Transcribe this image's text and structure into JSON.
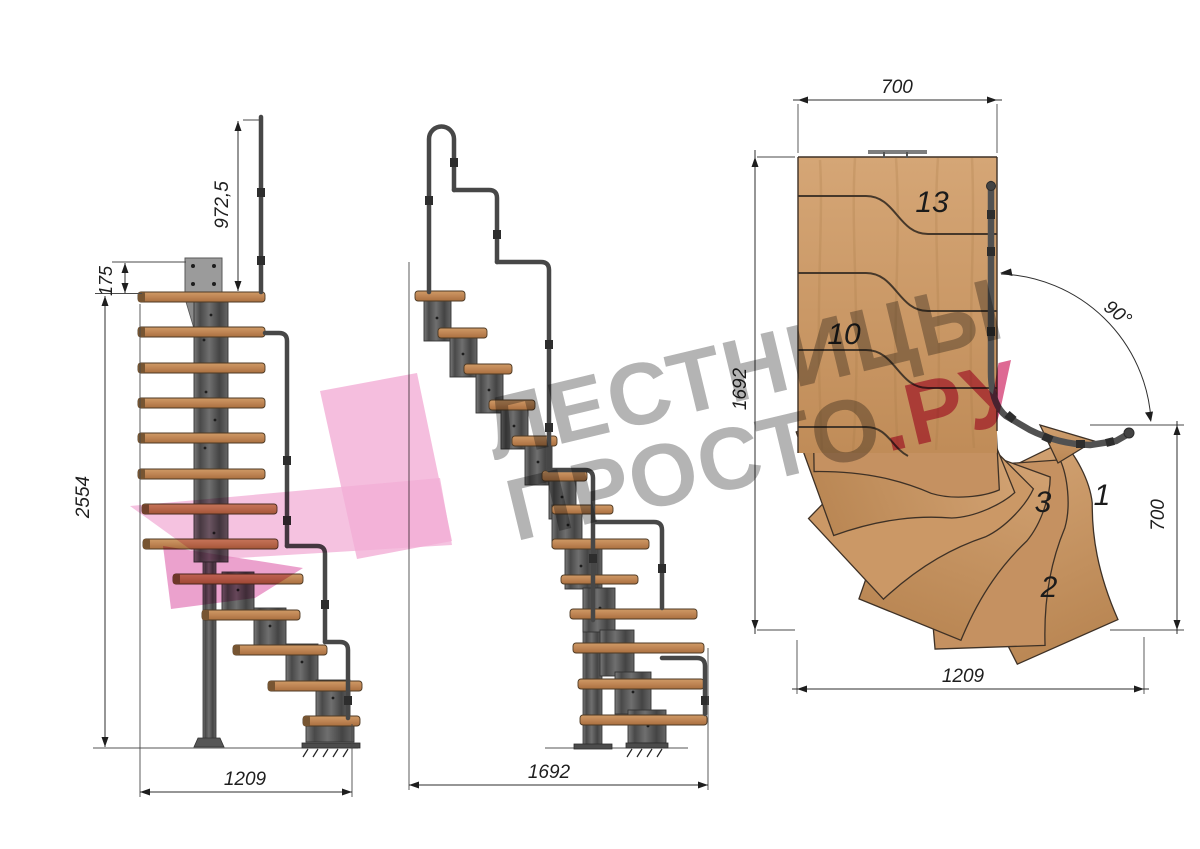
{
  "watermark": {
    "line1": "ЛЕСТНИЦЫ",
    "line2": "ПРОСТО",
    "line2_suffix": ".РУ"
  },
  "side_view": {
    "dim_rail_height": "972,5",
    "dim_top_offset": "175",
    "dim_total_height": "2554",
    "dim_run_length": "1209"
  },
  "front_view": {
    "dim_run_length": "1692"
  },
  "plan_view": {
    "dim_top_width": "700",
    "dim_left_length": "1692",
    "dim_turn_angle": "90°",
    "dim_right_width": "700",
    "dim_bottom_length": "1209",
    "tread_13": "13",
    "tread_10": "10",
    "tread_3": "3",
    "tread_1": "1",
    "tread_2": "2"
  },
  "colors": {
    "wood": "#c99a6a",
    "metal": "#4f4f4f",
    "dimension_ink": "#1e1e1e",
    "watermark_gray": "#a7a7a7",
    "watermark_pink": "#d84e80",
    "logo_pink": "#f2aed6"
  }
}
